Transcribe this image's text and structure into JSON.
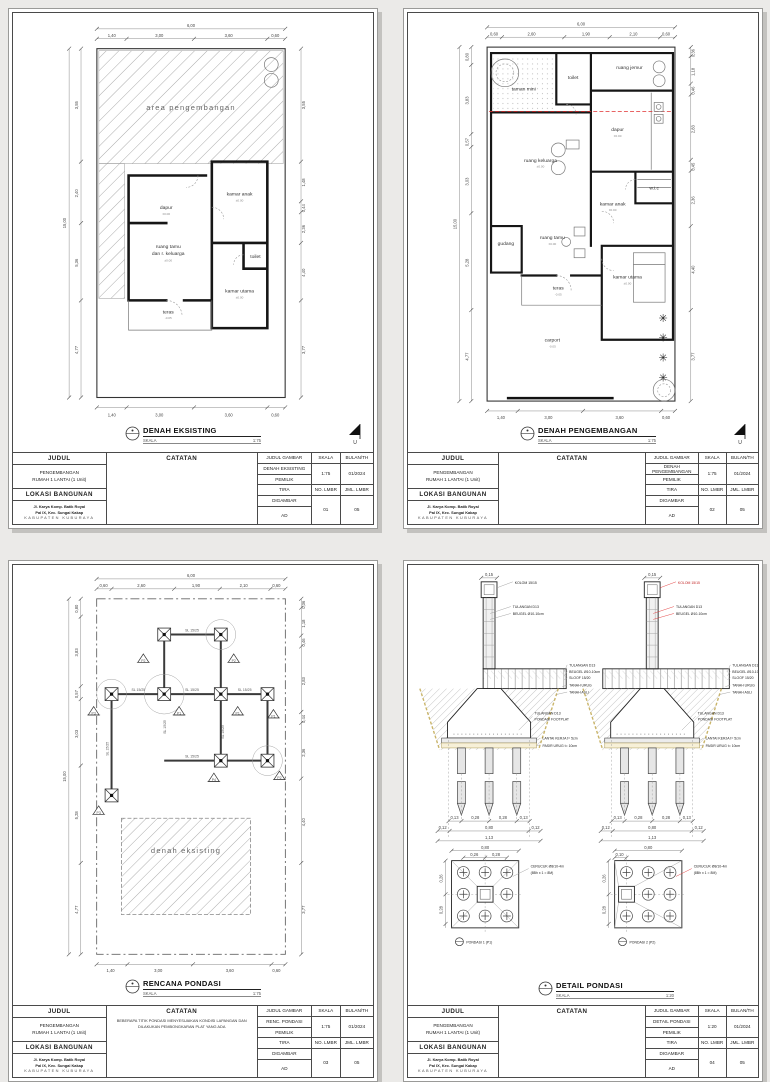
{
  "colors": {
    "background": "#ebeae8",
    "paper": "#ffffff",
    "accent_red": "#e03030",
    "sand": "#c9b469",
    "line": "#161616"
  },
  "common": {
    "skala_label": "SKALA",
    "north": "U",
    "tree_glyph": "✳",
    "elev_zero": "±0.00",
    "elev_minus": "-0.05",
    "bulan": "01/2024",
    "jml_lmbr": "05",
    "pemilik": "TIRA",
    "digambar": "AD"
  },
  "titleblock": {
    "judul_h": "JUDUL",
    "catatan_h": "CATATAN",
    "judul_gambar_h": "JUDUL GAMBAR",
    "skala_h": "SKALA",
    "bulan_h": "BULAN/TH",
    "pemilik_h": "PEMILIK",
    "digambar_h": "DIGAMBAR",
    "no_lmbr_h": "NO. LMBR",
    "jml_lmbr_h": "JML. LMBR",
    "lokasi_h": "LOKASI BANGUNAN",
    "judul1": "PENGEMBANGAN",
    "judul2": "RUMAH 1 LANTAI (1 Unit)",
    "alamat1": "Jl. Karya Komp. Batik Royal",
    "alamat2": "Pal IX, Kec. Sungai Kakap",
    "alamat3": "KABUPATEN KUBURAYA"
  },
  "s1": {
    "title": "DENAH EKSISTING",
    "judul_gambar": "DENAH EKSISTING",
    "skala": "1:75",
    "no_lmbr": "01",
    "catatan": "",
    "rooms": {
      "area": "area pengembangan",
      "dapur": "dapur",
      "kamar_anak": "kamar anak",
      "toilet": "toilet",
      "ruang_tamu_1": "ruang tamu",
      "ruang_tamu_2": "dan r. keluarga",
      "kamar_utama": "kamar utama",
      "teras": "teras"
    },
    "dims": {
      "top_overall": "6,00",
      "top": [
        "1,40",
        "3,00",
        "3,60",
        "0,60"
      ],
      "left": [
        "3,55",
        "2,40",
        "5,36",
        "4,77"
      ],
      "left_overall": "15,00",
      "right": [
        "3,55",
        "1,48",
        "0,44",
        "2,36",
        "4,40",
        "3,77"
      ]
    }
  },
  "s2": {
    "title": "DENAH PENGEMBANGAN",
    "judul_gambar": "DENAH PENGEMBANGAN",
    "skala": "1:75",
    "no_lmbr": "02",
    "catatan": "",
    "rooms": {
      "taman": "taman mini",
      "toilet": "toilet",
      "jemur": "ruang jemur",
      "dapur": "dapur",
      "keluarga": "ruang keluarga",
      "gudang": "gudang",
      "tamu": "ruang tamu",
      "kamar_anak": "kamar anak",
      "wic": "w.i.c",
      "kamar_utama": "kamar utama",
      "teras": "teras",
      "carport": "carport"
    },
    "dims": {
      "top_overall": "6,00",
      "top": [
        "0,60",
        "2,60",
        "1,90",
        "2,10",
        "0,60"
      ],
      "bottom": [
        "1,40",
        "3,00",
        "3,60",
        "0,60"
      ],
      "left": [
        "0,80",
        "3,83",
        "0,57",
        "3,03",
        "5,28",
        "4,77"
      ],
      "left_overall": "15,00",
      "right": [
        "0,36",
        "1,18",
        "0,46",
        "2,83",
        "0,45",
        "2,36",
        "4,40",
        "3,77"
      ]
    }
  },
  "s3": {
    "title": "RENCANA PONDASI",
    "judul_gambar": "RENC. PONDASI",
    "skala": "1:75",
    "no_lmbr": "03",
    "catatan": "BEBERAPA TITIK PONDASI MENYESUAIKAN KONDISI LAPANGAN DAN DILAKUKAN PEMBONGKARAN PLAT YANG ADA",
    "labels": {
      "area": "denah eksisting",
      "sloof": "SL 15/25",
      "p1": "P1",
      "p2": "P2",
      "p3": "P3",
      "p4": "P4"
    },
    "dims": {
      "top_overall": "6,00",
      "top": [
        "0,60",
        "2,60",
        "1,90",
        "2,10",
        "0,60"
      ],
      "bottom": [
        "1,40",
        "3,00",
        "3,60",
        "0,60"
      ],
      "left": [
        "0,80",
        "3,83",
        "0,57",
        "3,03",
        "5,28",
        "4,77"
      ],
      "left_overall": "15,00",
      "right": [
        "0,36",
        "1,18",
        "0,46",
        "2,83",
        "0,44",
        "2,36",
        "4,40",
        "3,77"
      ]
    }
  },
  "s4": {
    "title": "DETAIL PONDASI",
    "judul_gambar": "DETAIL PONDASI",
    "skala": "1:20",
    "no_lmbr": "04",
    "catatan": "",
    "ann": {
      "kolom": "KOLOM 15/15",
      "tulangan": "TULANGAN D13",
      "beugel": "BEUGEL Ø10-10cm",
      "sloof": "SLOOF 15/20",
      "tanah_urug": "TANAH URUG",
      "tanah_asli": "TANAH ASLI",
      "footplat": "PONDASI FOOTPLAT",
      "lantai": "LANTAI KERJA t= 5cm",
      "pasir": "PASIR URUG t= 10cm",
      "cerucuk1": "CERUCUK Ø8/10-4m",
      "cerucuk2": "(8Bh x 1 = 8M)",
      "pondasi1": "PONDASI 1 (P1)",
      "pondasi2": "PONDASI 2 (P2)"
    },
    "dims": {
      "kolom_w": "0,15",
      "row1": [
        "0,13",
        "0,28",
        "0,28",
        "0,13"
      ],
      "row2": [
        "0,12",
        "0,80",
        "0,12"
      ],
      "row3": "1,13",
      "plan_w": "0,80",
      "plan_sub": [
        "0,26",
        "0,28"
      ],
      "plan2_sub": "0,10",
      "plan_left": [
        "0,26",
        "0,28"
      ]
    }
  }
}
